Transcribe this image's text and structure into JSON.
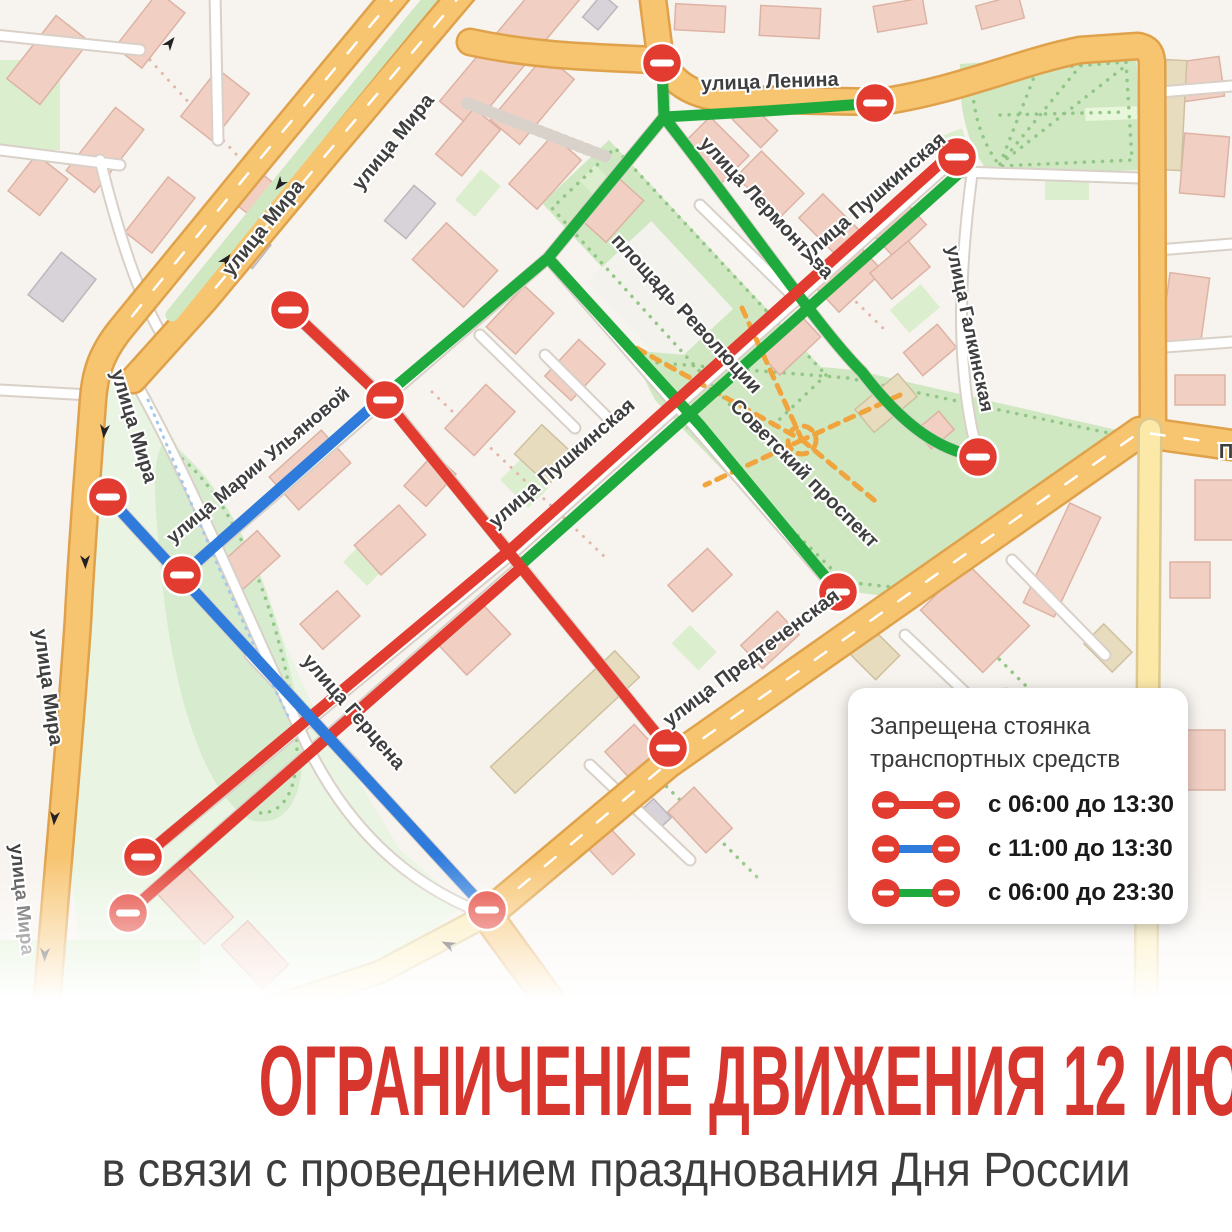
{
  "banner": {
    "title": "ОГРАНИЧЕНИЕ ДВИЖЕНИЯ 12 ИЮНЯ",
    "subtitle": "в связи с проведением празднования Дня России",
    "title_color": "#d7362e"
  },
  "legend": {
    "title_line1": "Запрещена стоянка",
    "title_line2": "транспортных средств",
    "rows": [
      {
        "icon": "no-entry-dumbbell",
        "color": "#e23b30",
        "label": "с 06:00 до 13:30"
      },
      {
        "icon": "no-entry-dumbbell",
        "color": "#2f7bdb",
        "label": "с 11:00 до 13:30"
      },
      {
        "icon": "no-entry-dumbbell",
        "color": "#1faa3e",
        "label": "с 06:00 до 23:30"
      }
    ]
  },
  "map": {
    "streets": [
      {
        "text": "улица Ленина"
      },
      {
        "text": "улица Лермонтова"
      },
      {
        "text": "улица Пушкинская"
      },
      {
        "text": "улица Пушкинская"
      },
      {
        "text": "улица Галкинская"
      },
      {
        "text": "площадь Революции"
      },
      {
        "text": "Советский проспект"
      },
      {
        "text": "улица Предтеченская"
      },
      {
        "text": "улица Марии Ульяновой"
      },
      {
        "text": "улица Герцена"
      },
      {
        "text": "улица Мира"
      },
      {
        "text": "улица Мира"
      },
      {
        "text": "улица Мира"
      },
      {
        "text": "улица Мира"
      },
      {
        "text": "улица Мира"
      },
      {
        "text": "П"
      }
    ],
    "icons": {
      "no_entry": "no-entry"
    },
    "colors": {
      "restriction_red": "#e23b30",
      "restriction_blue": "#2f7bdb",
      "restriction_green": "#1faa3e",
      "road_major": "#f7c470",
      "road_minor": "#ffffff",
      "park": "#cfe8c2",
      "building": "#f2cfc3",
      "background": "#f7f3ee"
    }
  }
}
